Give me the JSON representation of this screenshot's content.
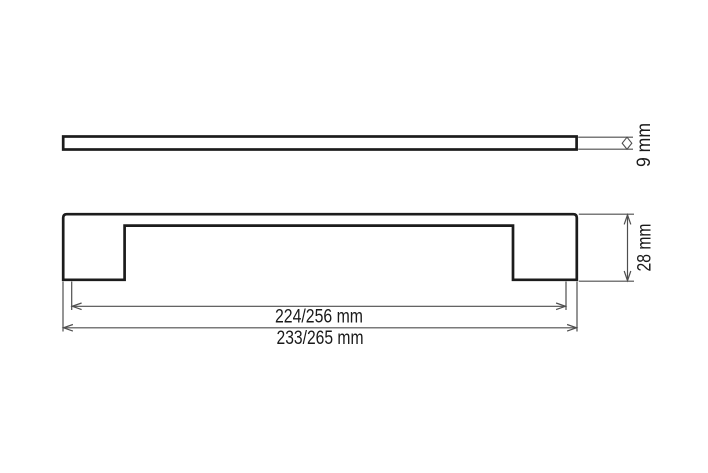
{
  "drawing": {
    "type": "technical-dimension-drawing",
    "views": {
      "side_profile": "thin bar profile (top view)",
      "front_profile": "handle front profile with two mounting legs"
    },
    "dimensions": {
      "bar_thickness": {
        "label": "9 mm"
      },
      "handle_height": {
        "label": "28 mm"
      },
      "hole_spacing": {
        "label": "224/256 mm"
      },
      "overall_length": {
        "label": "233/265 mm"
      }
    },
    "colors": {
      "outline": "#1c1c1c",
      "dimension_line": "#4e4e4e",
      "background": "#ffffff"
    }
  }
}
